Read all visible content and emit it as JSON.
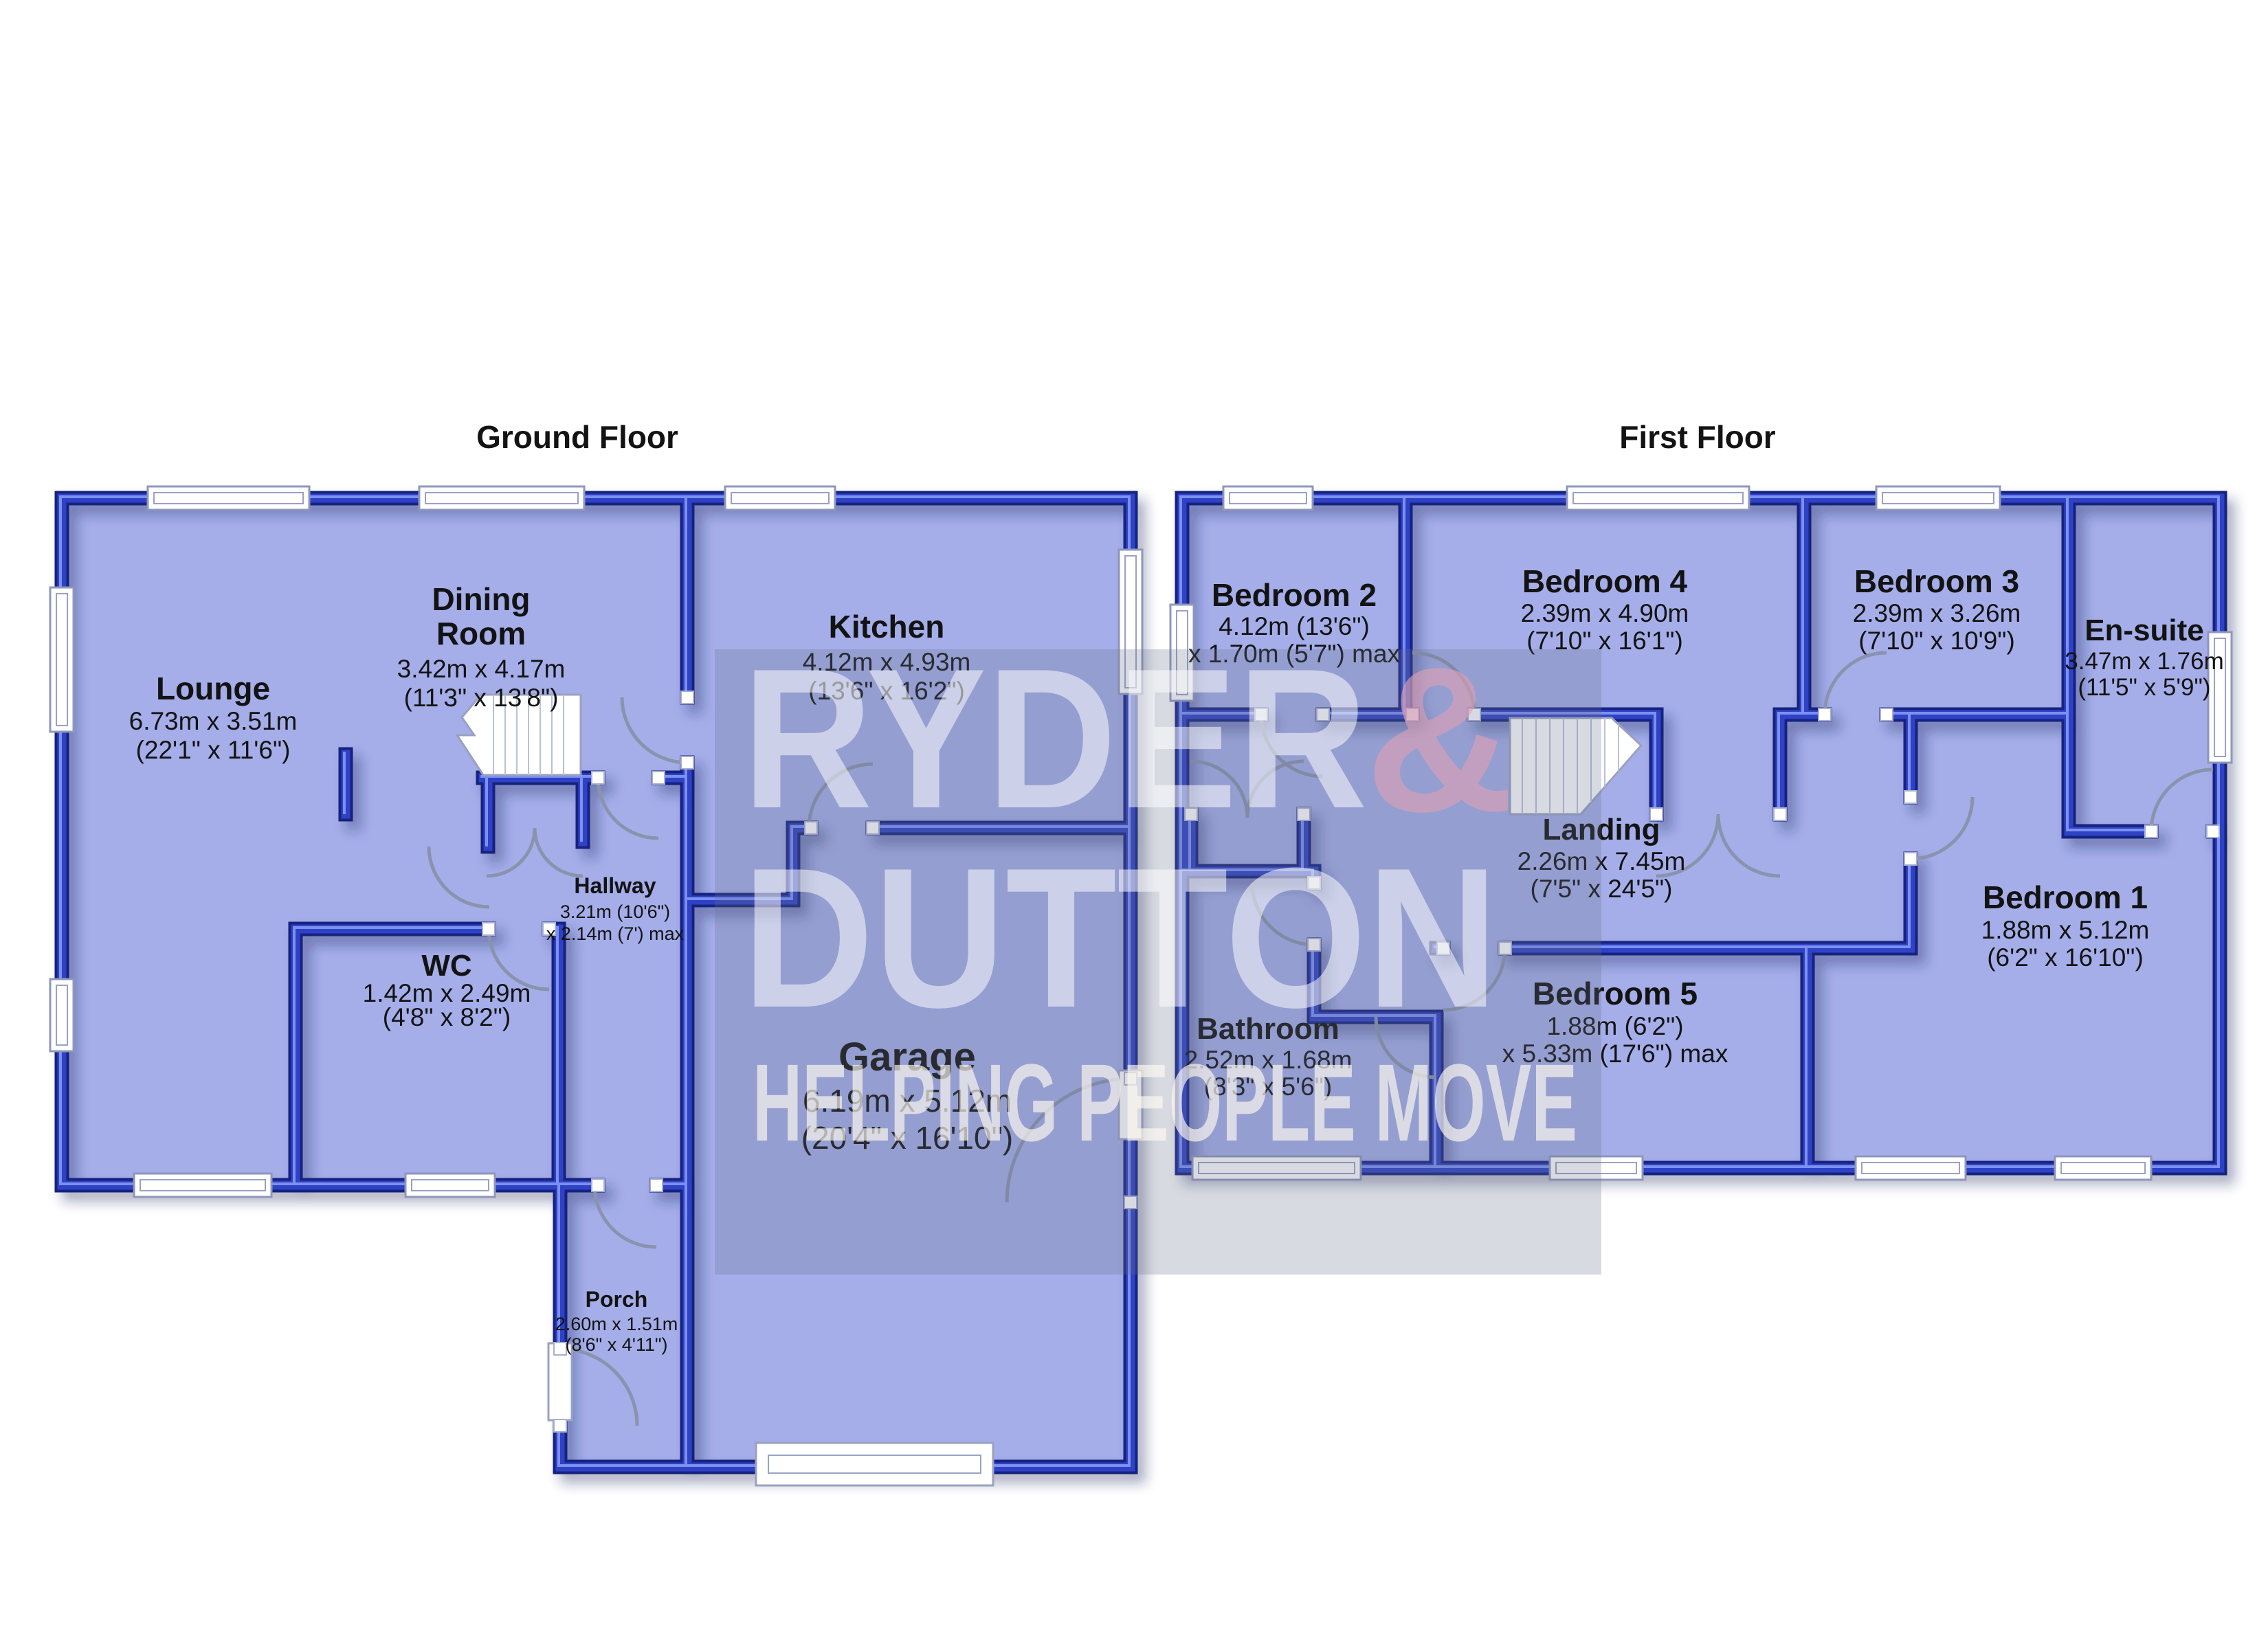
{
  "watermark": {
    "brand_line1": "RYDER",
    "brand_amp": "&",
    "brand_line2": "DUTTON",
    "tagline": "HELPING PEOPLE MOVE",
    "white": "#ffffff",
    "amp_pink": "#dfa0b4"
  },
  "colors": {
    "wall_blue": "#2e42c6",
    "wall_dark": "#18227e",
    "room_fill": "#a5aee9",
    "label_color": "#131313",
    "background": "#ffffff"
  },
  "ground_floor": {
    "title": "Ground Floor",
    "rooms": {
      "lounge": {
        "name": "Lounge",
        "metric": "6.73m x 3.51m",
        "imperial": "(22'1\" x 11'6\")"
      },
      "dining": {
        "name1": "Dining",
        "name2": "Room",
        "metric": "3.42m x 4.17m",
        "imperial": "(11'3\" x 13'8\")"
      },
      "kitchen": {
        "name": "Kitchen",
        "metric": "4.12m x 4.93m",
        "imperial": "(13'6\" x 16'2\")"
      },
      "hallway": {
        "name": "Hallway",
        "metric": "3.21m (10'6\")",
        "imperial": "x 2.14m (7') max"
      },
      "wc": {
        "name": "WC",
        "metric": "1.42m x 2.49m",
        "imperial": "(4'8\" x 8'2\")"
      },
      "garage": {
        "name": "Garage",
        "metric": "6.19m x 5.12m",
        "imperial": "(20'4\" x 16'10\")"
      },
      "porch": {
        "name": "Porch",
        "metric": "2.60m x 1.51m",
        "imperial": "(8'6\" x 4'11\")"
      }
    }
  },
  "first_floor": {
    "title": "First Floor",
    "rooms": {
      "bedroom2": {
        "name": "Bedroom 2",
        "metric": "4.12m (13'6\")",
        "imperial": "x 1.70m (5'7\") max"
      },
      "bedroom4": {
        "name": "Bedroom 4",
        "metric": "2.39m x 4.90m",
        "imperial": "(7'10\" x 16'1\")"
      },
      "bedroom3": {
        "name": "Bedroom 3",
        "metric": "2.39m x 3.26m",
        "imperial": "(7'10\" x 10'9\")"
      },
      "ensuite": {
        "name": "En-suite",
        "metric": "3.47m x 1.76m",
        "imperial": "(11'5\" x 5'9\")"
      },
      "landing": {
        "name": "Landing",
        "metric": "2.26m x 7.45m",
        "imperial": "(7'5\" x 24'5\")"
      },
      "bathroom": {
        "name": "Bathroom",
        "metric": "2.52m x 1.68m",
        "imperial": "(8'3\" x 5'6\")"
      },
      "bedroom5": {
        "name": "Bedroom 5",
        "metric": "1.88m (6'2\")",
        "imperial": "x 5.33m (17'6\") max"
      },
      "bedroom1": {
        "name": "Bedroom 1",
        "metric": "1.88m x 5.12m",
        "imperial": "(6'2\" x 16'10\")"
      }
    }
  }
}
